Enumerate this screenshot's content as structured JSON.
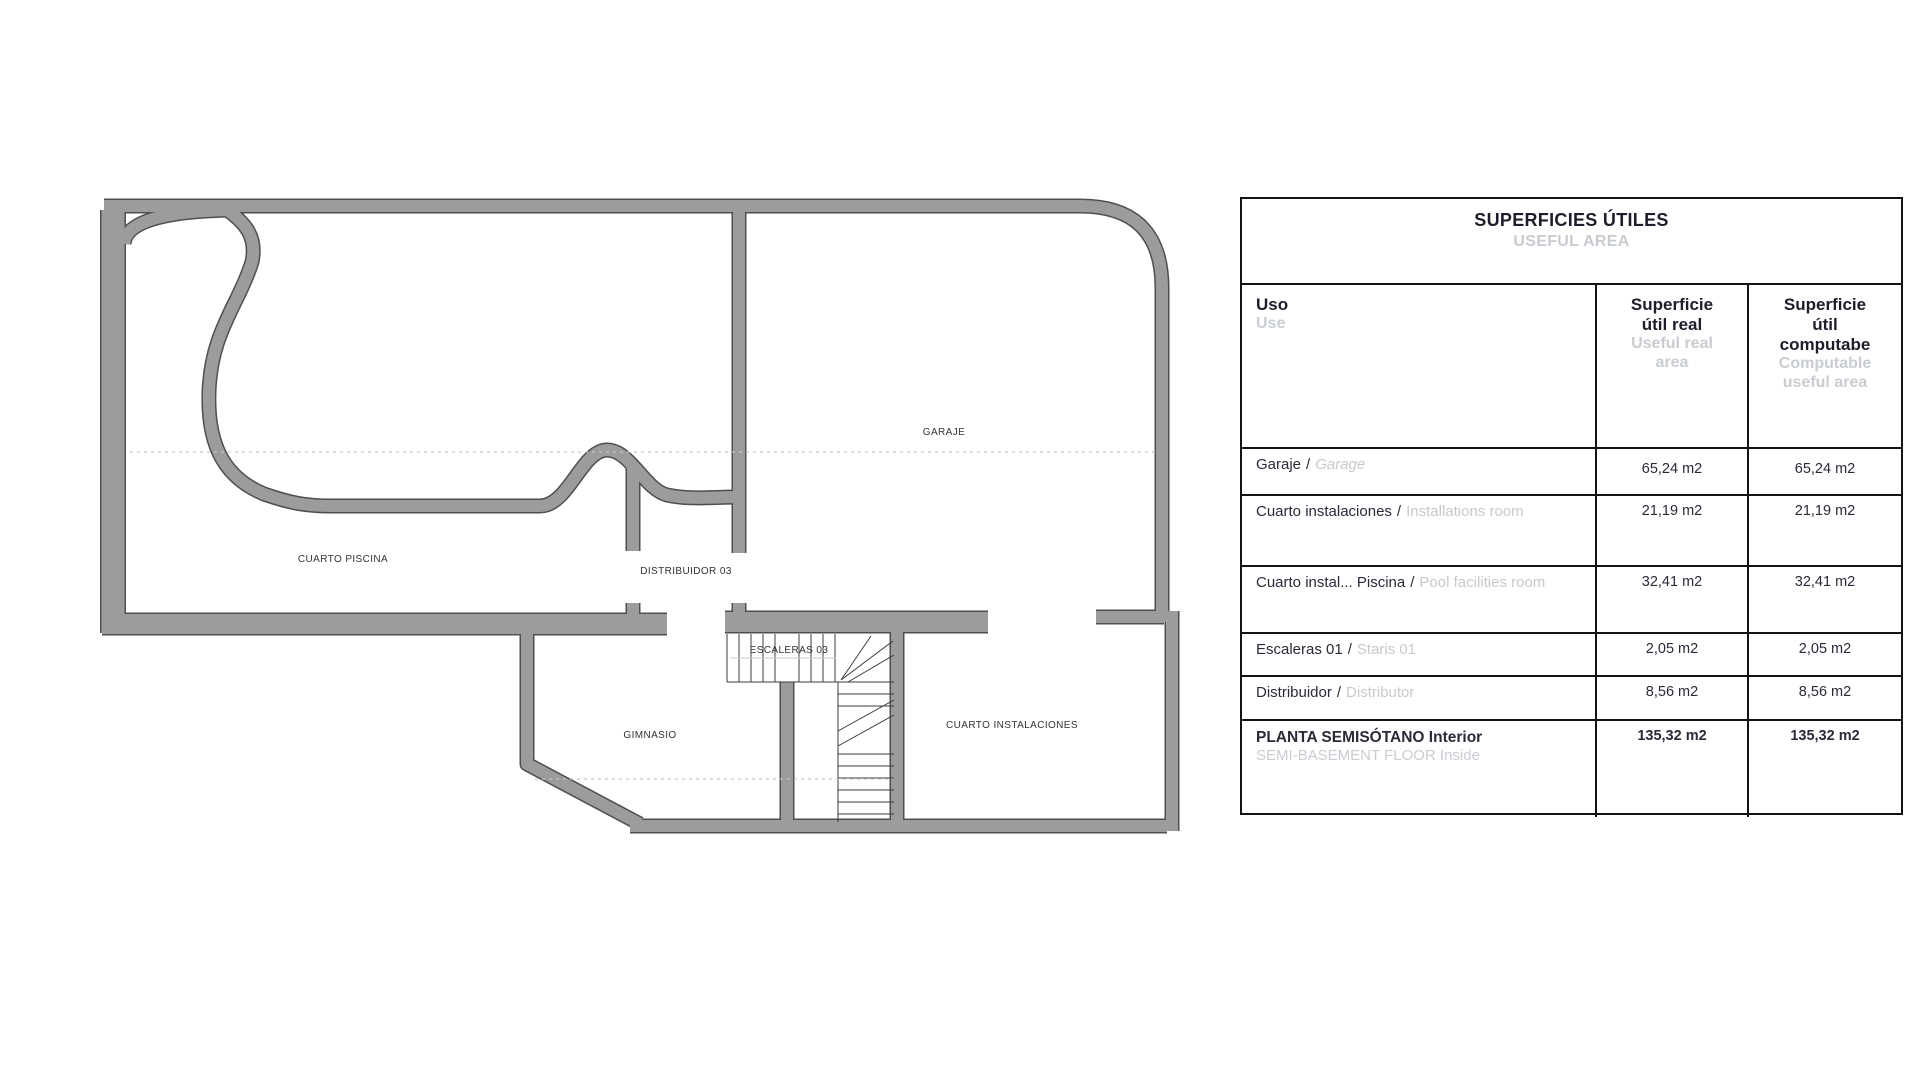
{
  "plan": {
    "labels": [
      {
        "id": "garaje",
        "text": "GARAJE"
      },
      {
        "id": "cuarto-piscina",
        "text": "CUARTO PISCINA"
      },
      {
        "id": "distribuidor-03",
        "text": "DISTRIBUIDOR 03"
      },
      {
        "id": "escaleras-03",
        "text": "ESCALERAS 03"
      },
      {
        "id": "gimnasio",
        "text": "GIMNASIO"
      },
      {
        "id": "cuarto-instalaciones",
        "text": "CUARTO INSTALACIONES"
      }
    ],
    "wall_color": "#9c9c9c",
    "wall_edge_color": "#4f4f4f"
  },
  "table": {
    "title": "SUPERFICIES ÚTILES",
    "subtitle": "USEFUL AREA",
    "separator": "/",
    "columns": {
      "uso": {
        "es": "Uso",
        "en": "Use"
      },
      "real": {
        "es": "Superficie útil real",
        "en": "Useful real area"
      },
      "comp": {
        "es": "Superficie útil computabe",
        "en": "Computable useful area"
      }
    },
    "rows": [
      {
        "es": "Garaje",
        "en": "Garage",
        "real": "65,24 m2",
        "comp": "65,24 m2"
      },
      {
        "es": "Cuarto instalaciones",
        "en": "Installations room",
        "real": "21,19 m2",
        "comp": "21,19 m2"
      },
      {
        "es": "Cuarto instal... Piscina",
        "en": "Pool facilities room",
        "real": "32,41 m2",
        "comp": "32,41 m2"
      },
      {
        "es": "Escaleras 01",
        "en": "Staris 01",
        "real": "2,05 m2",
        "comp": "2,05 m2"
      },
      {
        "es": "Distribuidor",
        "en": "Distributor",
        "real": "8,56 m2",
        "comp": "8,56 m2"
      },
      {
        "es": "PLANTA SEMISÓTANO Interior",
        "en": "SEMI-BASEMENT FLOOR Inside",
        "real": "135,32 m2",
        "comp": "135,32 m2"
      }
    ]
  }
}
